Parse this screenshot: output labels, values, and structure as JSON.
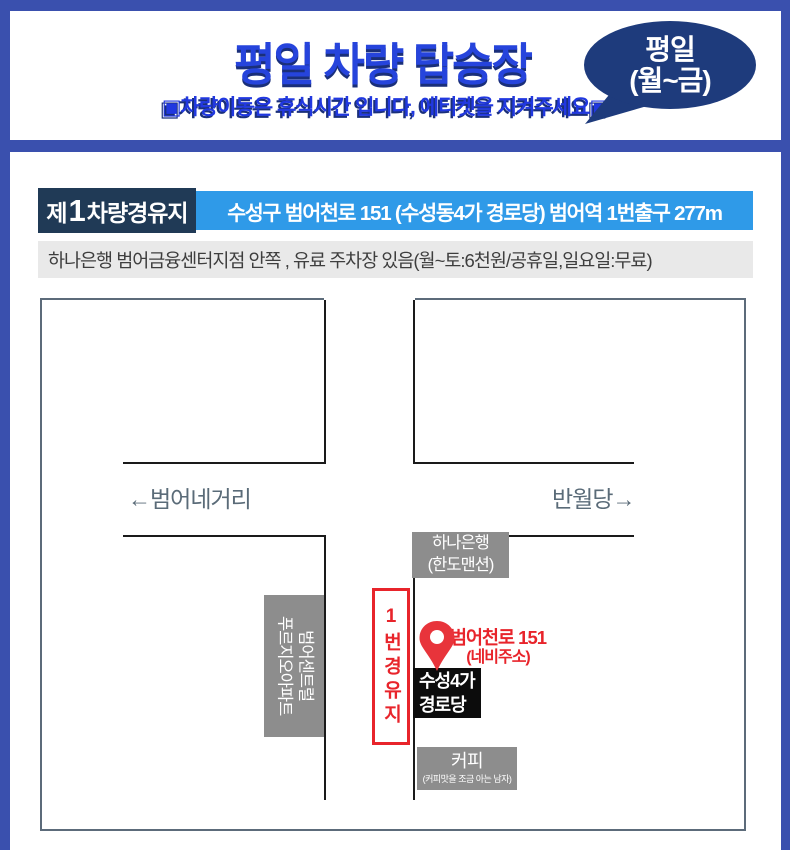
{
  "header": {
    "title": "평일 차량 탑승장",
    "subtitle": "▣차량이동은 휴식시간 입니다, 에티켓을 지켜주세요▣",
    "bubble_line1": "평일",
    "bubble_line2": "(월~금)"
  },
  "section": {
    "label_prefix": "제",
    "label_number": "1",
    "label_suffix": "차량경유지",
    "address": "수성구 범어천로 151 (수성동4가 경로당) 범어역 1번출구 277m",
    "note": "하나은행 범어금융센터지점 안쪽 , 유료 주차장 있음(월~토:6천원/공휴일,일요일:무료)"
  },
  "map": {
    "direction_left": "←범어네거리",
    "direction_right": "반월당→",
    "bank_line1": "하나은행",
    "bank_line2": "(한도맨션)",
    "apartment_line1": "범어센트럴",
    "apartment_line2": "푸르지오아파트",
    "waypoint_label": "1번경유지",
    "pin_address_line1": "범어천로 151",
    "pin_address_line2": "(네비주소)",
    "hall_line1": "수성4가",
    "hall_line2": "경로당",
    "coffee_line1": "커피",
    "coffee_line2": "(커피맛을 조금 아는 남자)"
  },
  "colors": {
    "frame_blue": "#3a50ae",
    "title_blue": "#2644dc",
    "subtitle_blue": "#2138e0",
    "shadow_navy": "#1a2f7a",
    "bubble_navy": "#1e3b7c",
    "section_navy": "#203a56",
    "section_blue": "#2f9ae8",
    "note_bg": "#e9e9e9",
    "accent_red": "#e8242b",
    "building_gray": "#8d8d8d",
    "hall_black": "#0c0c0c",
    "road_black": "#1a1a1a",
    "direction_gray": "#5a6b78",
    "map_border_gray": "#5c6b7a"
  }
}
